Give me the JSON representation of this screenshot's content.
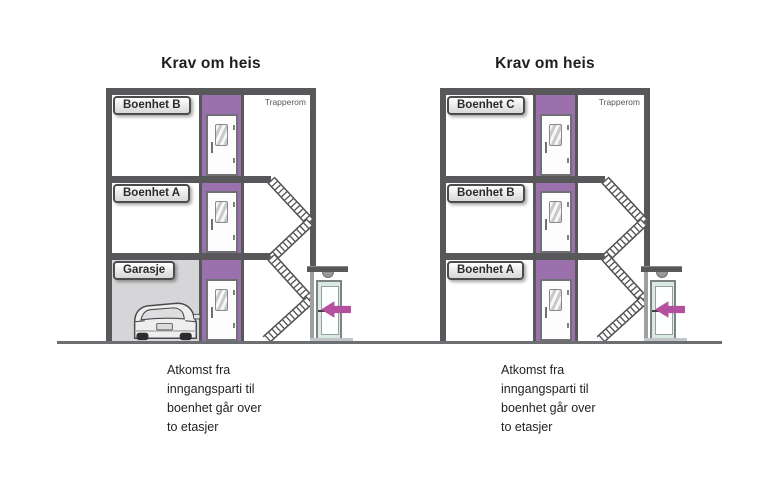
{
  "diagram": {
    "background": "#ffffff",
    "panels": [
      {
        "title": "Krav om heis",
        "stairwell_label": "Trapperom",
        "floor_labels": [
          "Boenhet B",
          "Boenhet A",
          "Garasje"
        ],
        "ground_floor_type": "garage",
        "caption_lines": [
          "Atkomst fra",
          "inngangsparti til",
          "boenhet går over",
          "to etasjer"
        ]
      },
      {
        "title": "Krav om heis",
        "stairwell_label": "Trapperom",
        "floor_labels": [
          "Boenhet C",
          "Boenhet B",
          "Boenhet A"
        ],
        "ground_floor_type": "dwelling",
        "caption_lines": [
          "Atkomst fra",
          "inngangsparti til",
          "boenhet går over",
          "to etasjer"
        ]
      }
    ],
    "colors": {
      "wall": "#58585b",
      "elevator_shaft": "#9b71ad",
      "entrance_arrow": "#b4509e",
      "garage_fill": "#d6d6d8",
      "entrance_door": "#d9eae3",
      "ground_line": "#6d6e71",
      "label_border": "#4c4c4f",
      "stairs_outline": "#4f5052"
    }
  }
}
